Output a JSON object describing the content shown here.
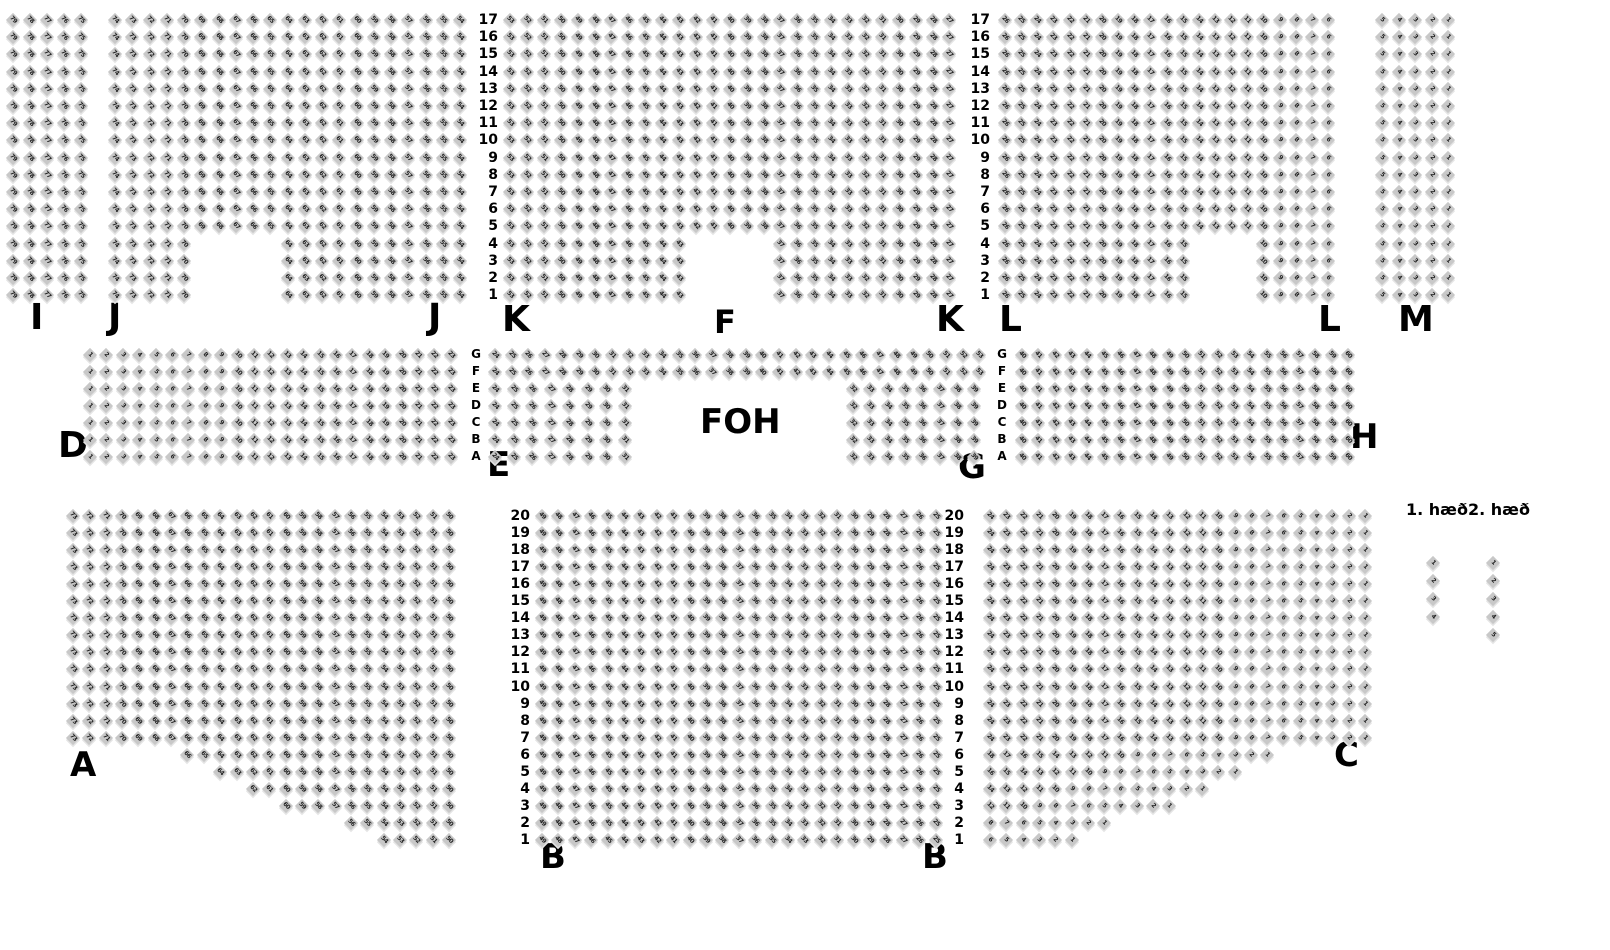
{
  "canvas": {
    "width": 1610,
    "height": 950,
    "background": "#ffffff"
  },
  "colors": {
    "seat_bg": "#c8c8c8",
    "seat_text": "#1f1f1f",
    "seat_shadow": "#e4e4e4",
    "label": "#000000"
  },
  "foh": {
    "text": "FOH"
  },
  "legend": {
    "labels": [
      {
        "text": "1. hæð"
      },
      {
        "text": "2. hæð"
      }
    ],
    "floor1_sample_seats": 4,
    "floor2_sample_seats": 5
  },
  "section_labels": [
    {
      "text": "I",
      "x": 30,
      "y": 300,
      "size": 36
    },
    {
      "text": "J",
      "x": 108,
      "y": 300,
      "size": 36
    },
    {
      "text": "J",
      "x": 428,
      "y": 300,
      "size": 36
    },
    {
      "text": "K",
      "x": 502,
      "y": 302,
      "size": 36
    },
    {
      "text": "K",
      "x": 936,
      "y": 302,
      "size": 36
    },
    {
      "text": "F",
      "x": 714,
      "y": 306,
      "size": 32
    },
    {
      "text": "L",
      "x": 999,
      "y": 302,
      "size": 36
    },
    {
      "text": "L",
      "x": 1318,
      "y": 302,
      "size": 36
    },
    {
      "text": "M",
      "x": 1398,
      "y": 302,
      "size": 36
    },
    {
      "text": "D",
      "x": 58,
      "y": 428,
      "size": 36
    },
    {
      "text": "E",
      "x": 487,
      "y": 448,
      "size": 34
    },
    {
      "text": "G",
      "x": 958,
      "y": 450,
      "size": 34
    },
    {
      "text": "H",
      "x": 1350,
      "y": 420,
      "size": 34
    },
    {
      "text": "A",
      "x": 70,
      "y": 748,
      "size": 34
    },
    {
      "text": "B",
      "x": 540,
      "y": 840,
      "size": 34
    },
    {
      "text": "B",
      "x": 922,
      "y": 840,
      "size": 34
    },
    {
      "text": "C",
      "x": 1334,
      "y": 738,
      "size": 34
    }
  ],
  "row_guides": [
    {
      "name": "top-row-numbers-left",
      "values": [
        "17",
        "16",
        "15",
        "14",
        "13",
        "12",
        "11",
        "10",
        "9",
        "8",
        "7",
        "6",
        "5",
        "4",
        "3",
        "2",
        "1"
      ],
      "x": 470,
      "width": 28,
      "align": "right",
      "y0": 13,
      "pitch": 17.2,
      "size": 14
    },
    {
      "name": "top-row-numbers-right",
      "values": [
        "17",
        "16",
        "15",
        "14",
        "13",
        "12",
        "11",
        "10",
        "9",
        "8",
        "7",
        "6",
        "5",
        "4",
        "3",
        "2",
        "1"
      ],
      "x": 962,
      "width": 28,
      "align": "right",
      "y0": 13,
      "pitch": 17.2,
      "size": 14
    },
    {
      "name": "middle-row-letters-left",
      "values": [
        "G",
        "F",
        "E",
        "D",
        "C",
        "B",
        "A"
      ],
      "x": 468,
      "width": 16,
      "align": "center",
      "y0": 348,
      "pitch": 17,
      "size": 12
    },
    {
      "name": "middle-row-letters-right",
      "values": [
        "G",
        "F",
        "E",
        "D",
        "C",
        "B",
        "A"
      ],
      "x": 994,
      "width": 16,
      "align": "center",
      "y0": 348,
      "pitch": 17,
      "size": 12
    },
    {
      "name": "bottom-row-numbers-left",
      "values": [
        "20",
        "19",
        "18",
        "17",
        "16",
        "15",
        "14",
        "13",
        "12",
        "11",
        "10",
        "9",
        "8",
        "7",
        "6",
        "5",
        "4",
        "3",
        "2",
        "1"
      ],
      "x": 500,
      "width": 30,
      "align": "right",
      "y0": 509,
      "pitch": 17.05,
      "size": 14
    },
    {
      "name": "bottom-row-numbers-right",
      "values": [
        "20",
        "19",
        "18",
        "17",
        "16",
        "15",
        "14",
        "13",
        "12",
        "11",
        "10",
        "9",
        "8",
        "7",
        "6",
        "5",
        "4",
        "3",
        "2",
        "1"
      ],
      "x": 934,
      "width": 30,
      "align": "right",
      "y0": 509,
      "pitch": 17.05,
      "size": 14
    }
  ],
  "seat_blocks": [
    {
      "name": "section-I",
      "x0": 8,
      "y0": 15,
      "cols": 5,
      "rows": 17,
      "px": 17,
      "py": 17.2,
      "numbering": {
        "mode": "colDesc",
        "start": 79
      }
    },
    {
      "name": "section-J",
      "x0": 110,
      "y0": 15,
      "cols": 21,
      "rows": 17,
      "px": 17.25,
      "py": 17.2,
      "numbering": {
        "mode": "colDesc",
        "start": 74
      },
      "omit": [
        {
          "rowNums": [
            1,
            4
          ],
          "cols": [
            6,
            10
          ]
        }
      ]
    },
    {
      "name": "section-K",
      "x0": 505,
      "y0": 15,
      "cols": 27,
      "rows": 17,
      "px": 16.9,
      "py": 17.2,
      "numbering": {
        "mode": "colDesc",
        "start": 53
      },
      "omit": [
        {
          "rowNums": [
            1,
            4
          ],
          "cols": [
            12,
            16
          ]
        }
      ]
    },
    {
      "name": "section-L",
      "x0": 1000,
      "y0": 15,
      "cols": 21,
      "rows": 17,
      "px": 16.15,
      "py": 17.2,
      "numbering": {
        "mode": "colDesc",
        "start": 26
      },
      "omit": [
        {
          "rowNums": [
            1,
            4
          ],
          "cols": [
            13,
            16
          ]
        }
      ]
    },
    {
      "name": "section-M",
      "x0": 1377,
      "y0": 15,
      "cols": 5,
      "rows": 17,
      "px": 16.5,
      "py": 17.2,
      "numbering": {
        "mode": "colDesc",
        "start": 5
      }
    },
    {
      "name": "section-D",
      "x0": 85,
      "y0": 350,
      "cols": 23,
      "rows": 7,
      "px": 16.4,
      "py": 17,
      "numbering": {
        "mode": "colAsc",
        "start": 1
      }
    },
    {
      "name": "section-F",
      "x0": 490,
      "y0": 350,
      "cols": 30,
      "rows": 2,
      "px": 16.7,
      "py": 17,
      "numbering": {
        "mode": "colAsc",
        "start": 24
      }
    },
    {
      "name": "section-E",
      "x0": 490,
      "y0": 384,
      "cols": 8,
      "rows": 5,
      "px": 18.5,
      "py": 17,
      "numbering": {
        "mode": "colAsc",
        "start": 24
      }
    },
    {
      "name": "section-G",
      "x0": 848,
      "y0": 384,
      "cols": 8,
      "rows": 5,
      "px": 17.3,
      "py": 17,
      "numbering": {
        "mode": "colAsc",
        "start": 32
      }
    },
    {
      "name": "section-H",
      "x0": 1017,
      "y0": 350,
      "cols": 21,
      "rows": 7,
      "px": 16.3,
      "py": 17,
      "numbering": {
        "mode": "colAsc",
        "start": 40
      }
    },
    {
      "name": "section-A",
      "x0": 68,
      "y0": 511,
      "cols": 24,
      "rows": 20,
      "px": 16.35,
      "py": 17.05,
      "numbering": {
        "mode": "colDesc",
        "start": 73
      },
      "omit": [
        {
          "rowNums": [
            6,
            6
          ],
          "cols": [
            1,
            7
          ]
        },
        {
          "rowNums": [
            5,
            5
          ],
          "cols": [
            1,
            9
          ]
        },
        {
          "rowNums": [
            4,
            4
          ],
          "cols": [
            1,
            11
          ]
        },
        {
          "rowNums": [
            3,
            3
          ],
          "cols": [
            1,
            13
          ]
        },
        {
          "rowNums": [
            2,
            2
          ],
          "cols": [
            1,
            17
          ]
        },
        {
          "rowNums": [
            1,
            1
          ],
          "cols": [
            1,
            19
          ]
        }
      ]
    },
    {
      "name": "section-B",
      "x0": 537,
      "y0": 511,
      "cols": 25,
      "rows": 20,
      "px": 16.4,
      "py": 17.05,
      "numbering": {
        "mode": "colDesc",
        "start": 49
      }
    },
    {
      "name": "section-C",
      "x0": 985,
      "y0": 511,
      "cols": 24,
      "rows": 20,
      "px": 16.3,
      "py": 17.05,
      "numbering": {
        "mode": "rowRTL",
        "start": 1
      },
      "omit": [
        {
          "rowNums": [
            6,
            6
          ],
          "cols": [
            19,
            24
          ]
        },
        {
          "rowNums": [
            5,
            5
          ],
          "cols": [
            17,
            24
          ]
        },
        {
          "rowNums": [
            4,
            4
          ],
          "cols": [
            15,
            24
          ]
        },
        {
          "rowNums": [
            3,
            3
          ],
          "cols": [
            13,
            24
          ]
        },
        {
          "rowNums": [
            2,
            2
          ],
          "cols": [
            9,
            24
          ]
        },
        {
          "rowNums": [
            1,
            1
          ],
          "cols": [
            7,
            24
          ]
        }
      ]
    },
    {
      "name": "legend-floor1-seats",
      "x0": 1428,
      "y0": 558,
      "cols": 1,
      "rows": 4,
      "px": 17,
      "py": 18,
      "numbering": {
        "mode": "rowAsc",
        "start": 1
      }
    },
    {
      "name": "legend-floor2-seats",
      "x0": 1488,
      "y0": 558,
      "cols": 1,
      "rows": 5,
      "px": 17,
      "py": 18,
      "numbering": {
        "mode": "rowAsc",
        "start": 1
      }
    }
  ]
}
